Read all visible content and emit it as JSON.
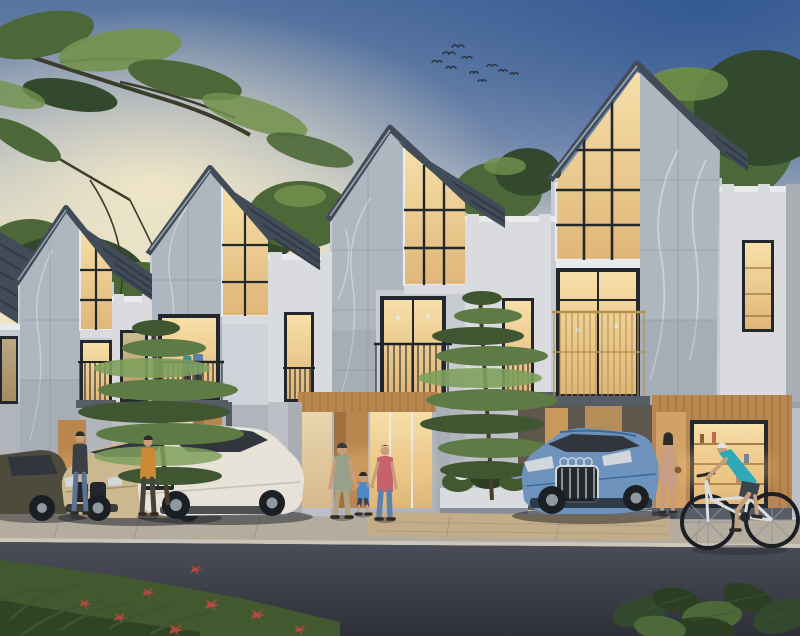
{
  "scene": {
    "description": "Dusk architectural rendering of four modern gabled townhouses with marble facades and warm lit windows; parked cars, residents walking, a couple on a balcony and a cyclist on the street",
    "time_of_day": "dusk",
    "wildlife": {
      "birds_in_flight": 10
    },
    "houses": [
      {
        "name": "townhouse-1",
        "marble_side": "left",
        "gable_window": "lit",
        "balcony_railing": "dark-metal"
      },
      {
        "name": "townhouse-2",
        "marble_side": "left",
        "gable_window": "lit",
        "balcony_railing": "dark-metal",
        "balcony_occupants": 2
      },
      {
        "name": "townhouse-3",
        "marble_side": "left",
        "gable_window": "lit",
        "balcony_railing": "dark-metal",
        "entry": "wood-door-with-glass"
      },
      {
        "name": "townhouse-4",
        "marble_side": "right",
        "gable_window": "lit",
        "balcony_railing": "gold",
        "entry": "wood-slat-wall-lit-shelves"
      }
    ],
    "vehicles": [
      {
        "name": "dark-olive-sedan",
        "color": "#4d4b3c"
      },
      {
        "name": "beige-luxury-sedan",
        "color": "#ccb88f"
      },
      {
        "name": "cream-electric-hatchback",
        "color": "#e7e2d7"
      },
      {
        "name": "blue-estate-wagon",
        "color": "#6d93bd"
      }
    ],
    "people": [
      {
        "name": "resident-dark-jacket",
        "top_color": "#3b3e44"
      },
      {
        "name": "resident-orange-sweater",
        "top_color": "#cd8a36"
      },
      {
        "name": "father-walking",
        "top_color": "#97a18a"
      },
      {
        "name": "boy-walking",
        "top_color": "#5087c5"
      },
      {
        "name": "mother-walking",
        "top_color": "#c6616d"
      },
      {
        "name": "woman-at-entry",
        "top_color": "#c89e86"
      },
      {
        "name": "cyclist",
        "top_color": "#2fa9b6"
      },
      {
        "name": "balcony-woman",
        "top_color": "#418f8e"
      },
      {
        "name": "balcony-man",
        "top_color": "#5c81a9"
      }
    ],
    "vegetation": [
      "overhanging-tree-branch",
      "background-tree-line",
      "front-pine-trees",
      "red-flower-bed",
      "lavender-planters",
      "large-leaf-foreground-plants"
    ]
  },
  "palette": {
    "skyTop": "#55739f",
    "skyTopRight": "#2f5590",
    "skyMid": "#94a3bc",
    "skyPale": "#c7cbc5",
    "skyHorizon": "#eee3c6",
    "skyGlow": "#f8ecc8",
    "bird": "#2b3340",
    "treeDark": "#33492e",
    "treeMid": "#4c6838",
    "treeLight": "#72924c",
    "branchWood": "#3c3c2c",
    "roof": "#424c59",
    "roofStripe": "#313a45",
    "roofEdge": "#9aa5b1",
    "marble": "#aeb6bf",
    "marbleLight": "#cdd3d9",
    "marbleShade": "#8b95a0",
    "marbleVein": "#e6eaee",
    "tileLine": "#6e7984",
    "wallWhite": "#d9dbdf",
    "wallLight": "#c8cbd0",
    "wallGray": "#a9aeb5",
    "wallShade": "#878d96",
    "trimDark": "#575d67",
    "winWarm": "#f7dfa8",
    "winWarmDeep": "#dfb678",
    "winFrame": "#23282f",
    "winCasing": "#e9eaec",
    "rail": "#20252b",
    "railGold": "#b5924f",
    "wood": "#b8864e",
    "woodDark": "#8c5f33",
    "woodLight": "#d0a169",
    "entryGlow": "#f6c87d",
    "posterWarm": "#d9a55e",
    "sidewalk": "#b3ac9f",
    "paver": "#c3ac87",
    "curb": "#cdc7bb",
    "joint": "#9f988b",
    "roadTop": "#4b4e59",
    "roadBottom": "#2f3139",
    "grass": "#42592f",
    "grassDark": "#2c3f23",
    "frond": "#3a5531",
    "flowerRed": "#b4493f",
    "flowerPurple": "#988dbf",
    "flowerWhite": "#e7e5db",
    "pine": "#5e7b46",
    "pineDark": "#3f5631",
    "pineLight": "#7ea05d",
    "trunk": "#4b3c29",
    "carOlive": "#4d4b3c",
    "carBeige": "#ccb88f",
    "carBeigeShade": "#a6926a",
    "carWhite": "#e7e2d7",
    "carWhiteShade": "#c5bfb1",
    "carBlue": "#6d93bd",
    "carBlueShade": "#40689b",
    "glassDark": "#31363d",
    "chrome": "#d2d7db",
    "tire": "#1b1e23",
    "hub": "#9098a0",
    "shadow": "#1d1f25",
    "skin": "#c79e7d",
    "hairDark": "#2d2925",
    "jacketDark": "#3b3e44",
    "jeans": "#5d7292",
    "sweaterOrange": "#cd8a36",
    "pantsDark": "#46433d",
    "capDark": "#343a41",
    "dadShirt": "#97a18a",
    "dadPants": "#b2a284",
    "boyShirt": "#5087c5",
    "boyShorts": "#3d4451",
    "momBeanie": "#7e3f49",
    "momTop": "#c6616d",
    "momJeans": "#6080aa",
    "dressTan": "#c89e86",
    "helmet": "#dee3e6",
    "jerseyTeal": "#2fa9b6",
    "bikeShorts": "#3b434d",
    "bikeFrame": "#dadddf",
    "spoke": "#8d949c",
    "balcTeal": "#418f8e",
    "balcBlue": "#5c81a9"
  }
}
